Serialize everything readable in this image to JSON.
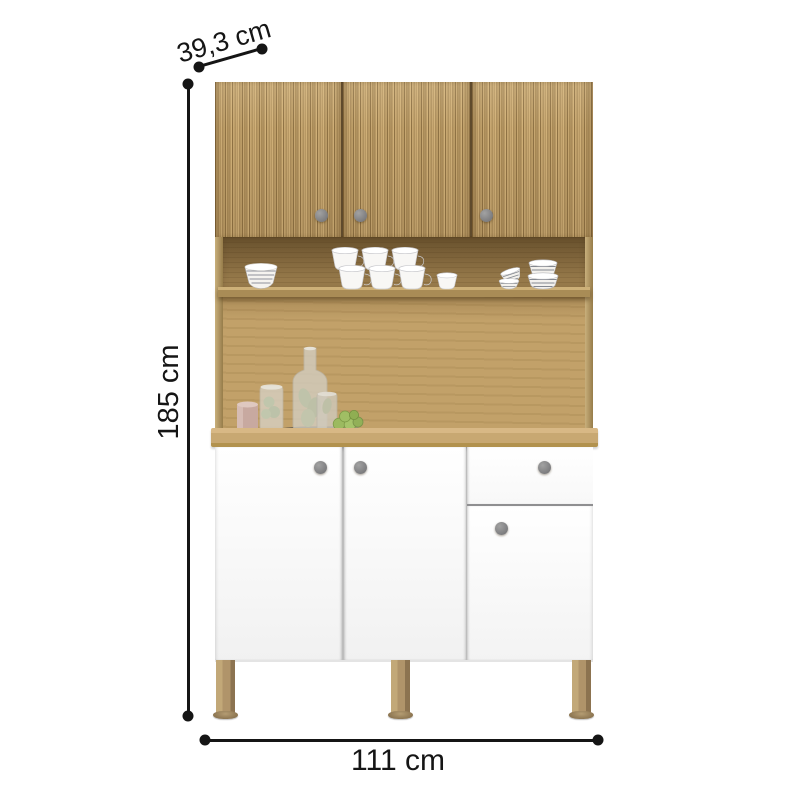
{
  "annotations": {
    "depth": {
      "label": "39,3 cm"
    },
    "height": {
      "label": "185 cm"
    },
    "width": {
      "label": "111 cm"
    }
  },
  "cabinet": {
    "upper_door_count": 3,
    "lower_door_count": 3,
    "drawer_count": 1,
    "knob_count": 7,
    "leg_count": 3,
    "shelf_items": [
      "striped-bowl-stack",
      "white-cup-stack-group",
      "small-white-cup",
      "small-striped-bowls",
      "striped-bowl-stack-right"
    ],
    "counter_items": [
      "candle",
      "glass-jar-with-plant",
      "glass-bottle-with-plant",
      "glass-cup-with-plant",
      "green-macarons-on-plate",
      "dark-tray"
    ]
  },
  "palette": {
    "annotation_black": "#151515",
    "fluted_wood_light": "#d0b078",
    "fluted_wood_dark": "#8f7244",
    "niche_wood": "#96794a",
    "back_panel_wood": "#c2a169",
    "countertop_wood": "#c8a872",
    "door_white": "#ffffff",
    "knob_gray": "#7d7d7f",
    "leg_tan": "#b0946a",
    "background": "#ffffff"
  }
}
